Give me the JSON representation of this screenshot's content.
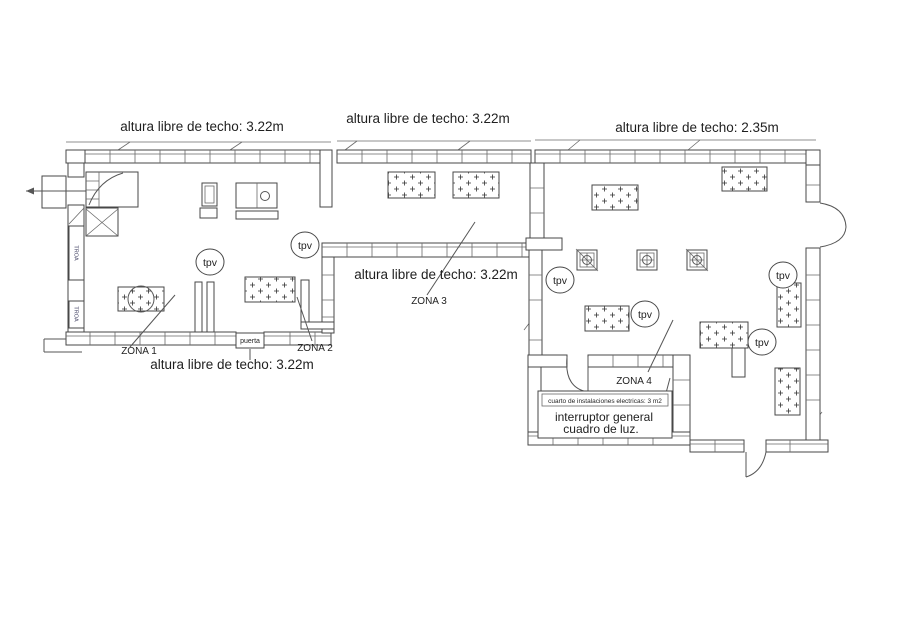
{
  "plan": {
    "title": "floor-plan",
    "ceiling_labels": {
      "top_left": "altura libre de techo: 3.22m",
      "top_middle": "altura libre de techo: 3.22m",
      "top_right": "altura libre de techo: 2.35m",
      "middle": "altura libre de techo: 3.22m",
      "bottom_left": "altura libre de techo: 3.22m"
    },
    "zones": {
      "z1": "ZONA 1",
      "z2": "ZONA 2",
      "z3": "ZONA 3",
      "z4": "ZONA 4"
    },
    "door_label": "puerta",
    "electrical": {
      "header": "cuarto de instalaciones electricas: 3 m2",
      "line1": "interruptor general",
      "line2": "cuadro de luz."
    },
    "tpv": "tpv",
    "duct_label": "TROA",
    "colors": {
      "line": "#474747",
      "text": "#1f1f1f",
      "background": "#ffffff"
    }
  }
}
